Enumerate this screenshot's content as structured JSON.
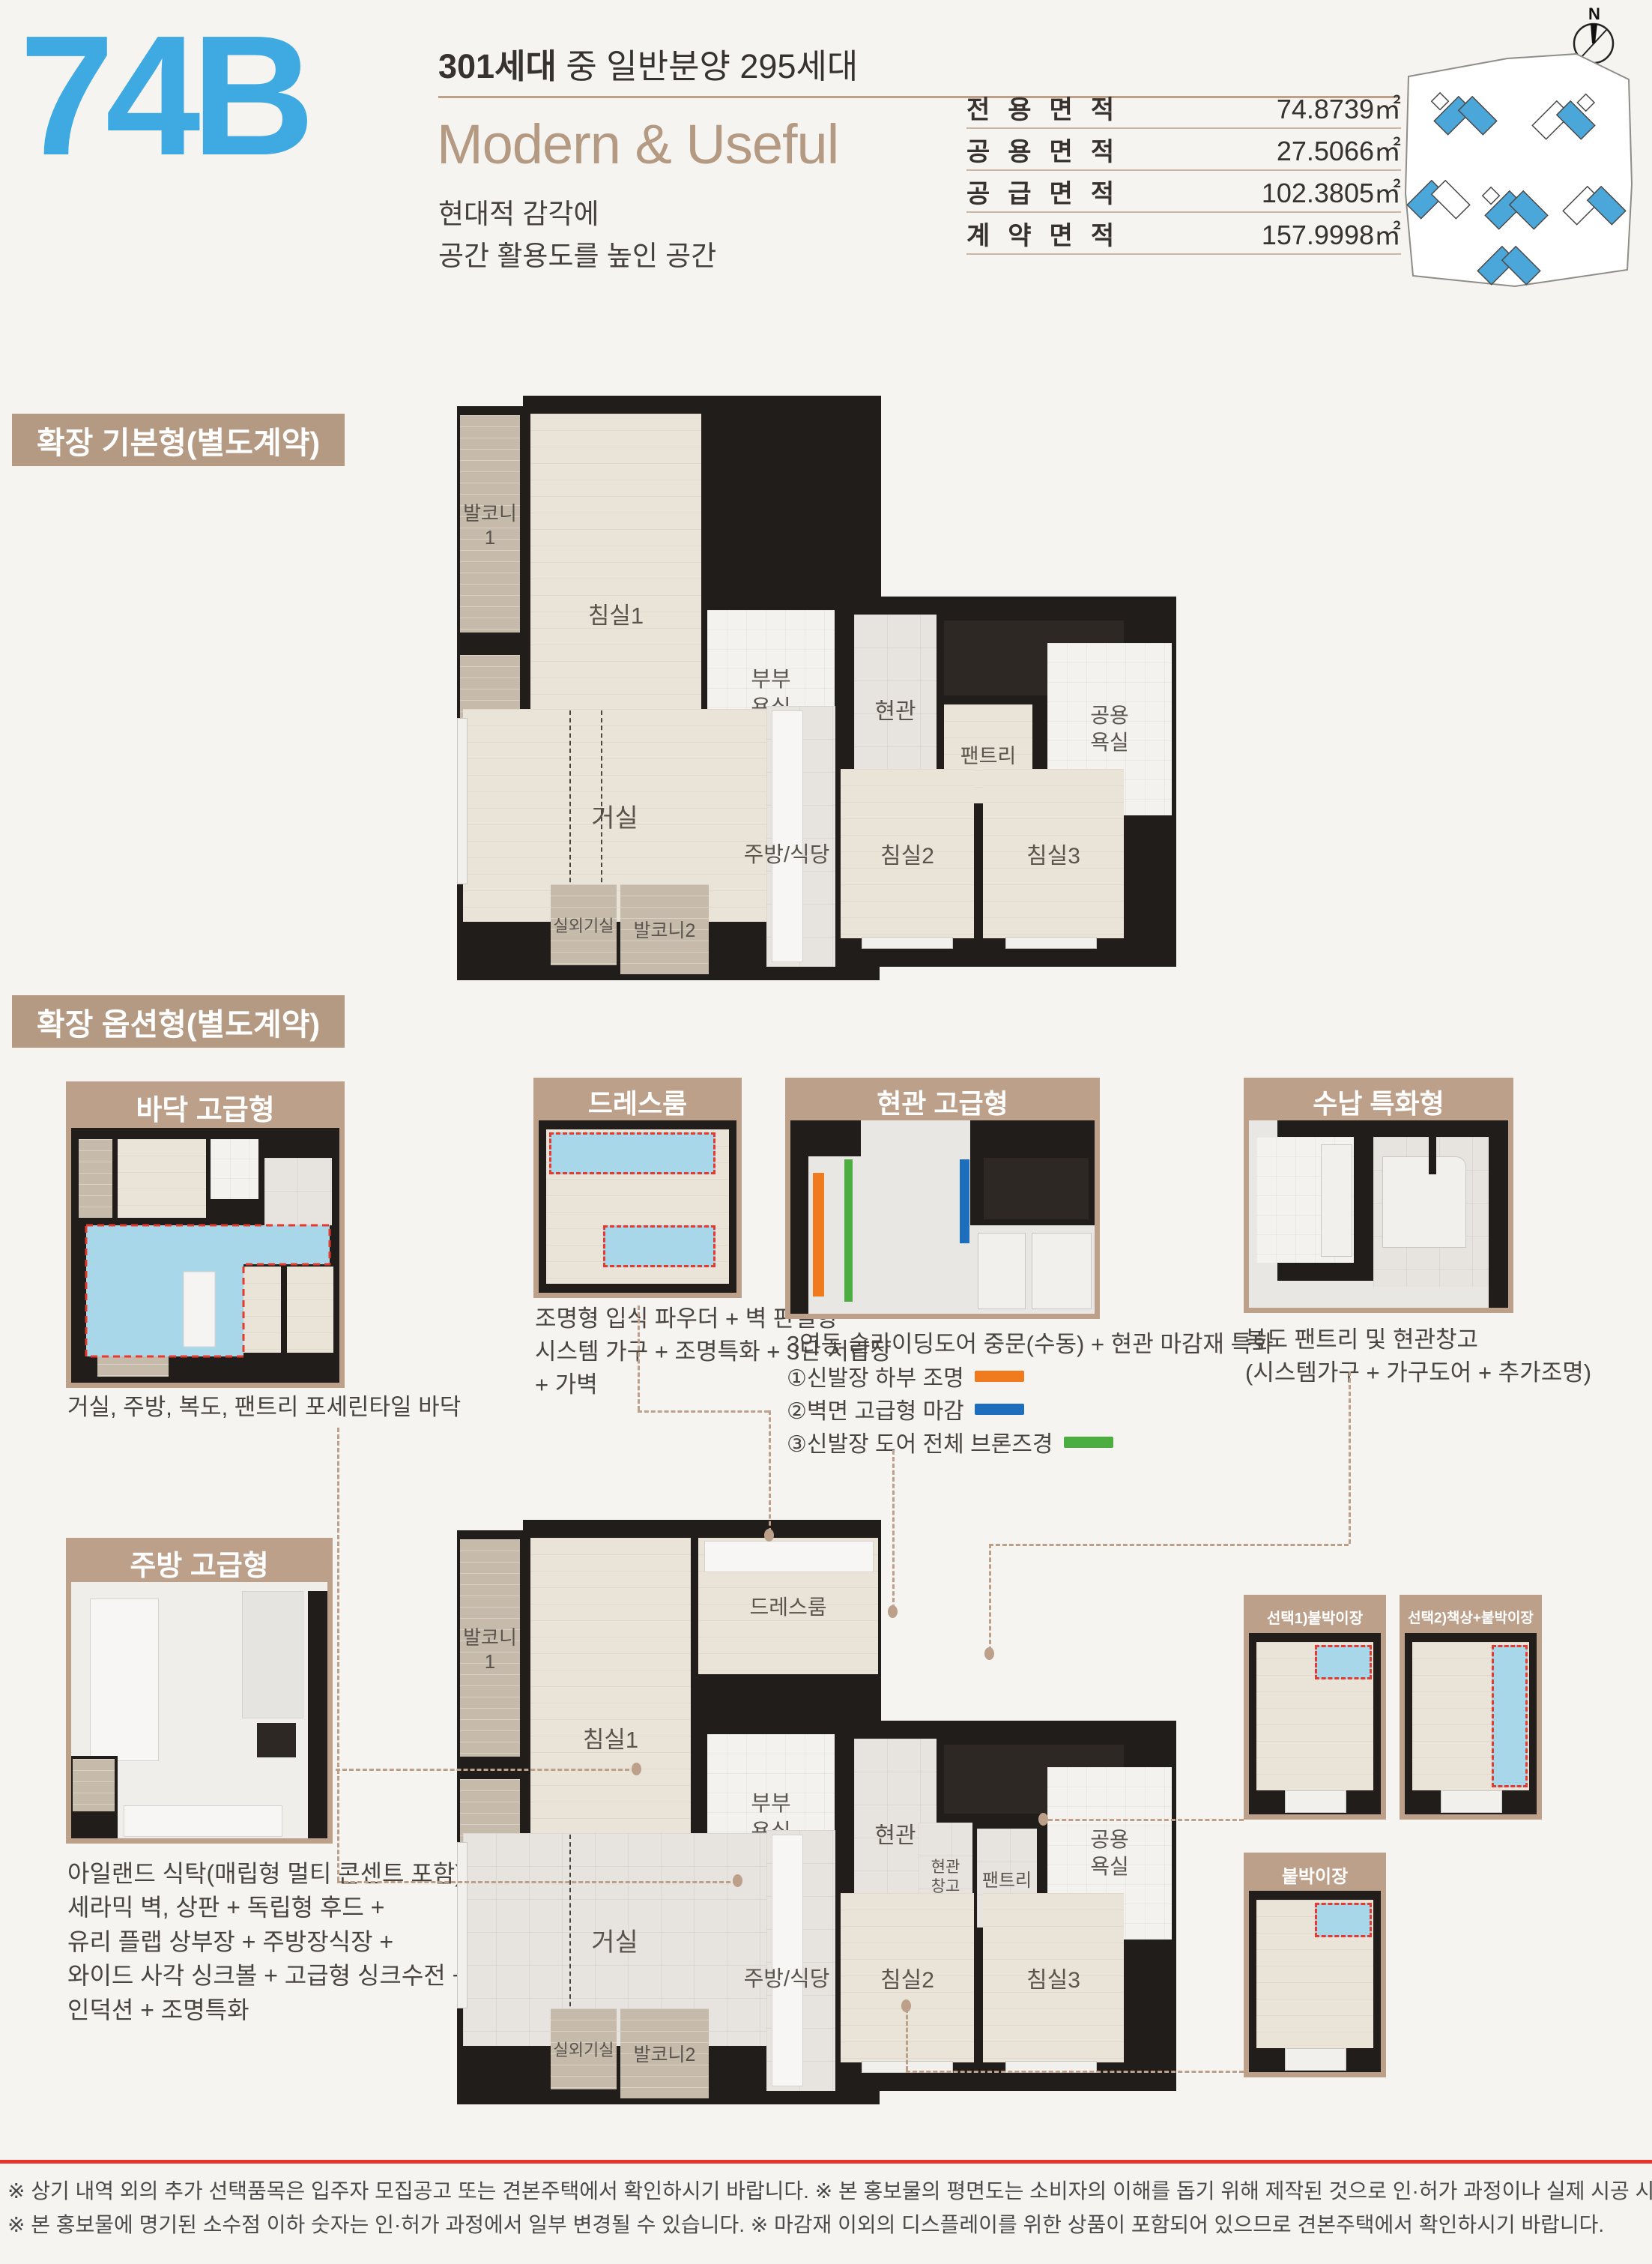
{
  "header": {
    "unit_code": "74B",
    "unit_color": "#3fa9e1",
    "households_strong": "301세대",
    "households_rest": " 중 일반분양 295세대",
    "tagline_en": "Modern & Useful",
    "tagline_ko_1": "현대적 감각에",
    "tagline_ko_2": "공간 활용도를 높인 공간",
    "compass": "N",
    "area_table": [
      {
        "label": "전용면적",
        "value": "74.8739㎡"
      },
      {
        "label": "공용면적",
        "value": "27.5066㎡"
      },
      {
        "label": "공급면적",
        "value": "102.3805㎡"
      },
      {
        "label": "계약면적",
        "value": "157.9998㎡"
      }
    ]
  },
  "sections": {
    "base_title": "확장 기본형(별도계약)",
    "option_title": "확장 옵션형(별도계약)"
  },
  "rooms": {
    "balcony1": "발코니1",
    "escape_1": "하향식",
    "escape_2": "피난구",
    "bedroom1": "침실1",
    "master_bath_1": "부부",
    "master_bath_2": "욕실",
    "entrance": "현관",
    "pantry": "팬트리",
    "common_bath_1": "공용",
    "common_bath_2": "욕실",
    "living": "거실",
    "kitchen": "주방/식당",
    "bedroom2": "침실2",
    "bedroom3": "침실3",
    "ac_room": "실외기실",
    "balcony2": "발코니2",
    "dressroom": "드레스룸",
    "entrance_storage_1": "현관",
    "entrance_storage_2": "창고"
  },
  "options": {
    "floor": {
      "title": "바닥 고급형",
      "caption": "거실, 주방, 복도, 팬트리 포세린타일 바닥"
    },
    "dress": {
      "title": "드레스룸",
      "caption_1": "조명형 입식 파우더 + 벽 판넬형",
      "caption_2": "시스템 가구 + 조명특화 + 3단 서랍장",
      "caption_3": "+ 가벽"
    },
    "entrance": {
      "title": "현관 고급형",
      "caption": "3연동 슬라이딩도어 중문(수동) + 현관 마감재 특화",
      "legend": [
        {
          "text": "①신발장 하부 조명",
          "color": "#f07a1e"
        },
        {
          "text": "②벽면 고급형 마감",
          "color": "#1d6fbd"
        },
        {
          "text": "③신발장 도어 전체 브론즈경",
          "color": "#4cae40"
        }
      ]
    },
    "storage": {
      "title": "수납 특화형",
      "caption_1": "복도 팬트리 및 현관창고",
      "caption_2": "(시스템가구 + 가구도어 + 추가조명)"
    },
    "kitchen": {
      "title": "주방 고급형",
      "caption_1": "아일랜드 식탁(매립형 멀티 콘센트 포함) +",
      "caption_2": "세라믹 벽, 상판 + 독립형 후드 +",
      "caption_3": "유리 플랩 상부장 + 주방장식장 +",
      "caption_4": "와이드 사각 싱크볼 + 고급형 싱크수전 +",
      "caption_5": "인덕션 + 조명특화"
    },
    "closet1": {
      "title": "선택1)붙박이장"
    },
    "closet2": {
      "title": "선택2)책상+붙박이장"
    },
    "closet3": {
      "title": "붙박이장"
    }
  },
  "footer": {
    "line1": "※ 상기 내역 외의 추가 선택품목은 입주자 모집공고 또는 견본주택에서 확인하시기 바랍니다. ※ 본 홍보물의 평면도는 소비자의 이해를 돕기 위해 제작된 것으로 인·허가 과정이나 실제 시공 시 현장 여건 등에 따라 다소 상이할 수 있습니다.",
    "line2": "※ 본 홍보물에 명기된 소수점 이하 숫자는 인·허가 과정에서 일부 변경될 수 있습니다. ※ 마감재 이외의 디스플레이를 위한 상품이 포함되어 있으므로 견본주택에서 확인하시기 바랍니다."
  }
}
